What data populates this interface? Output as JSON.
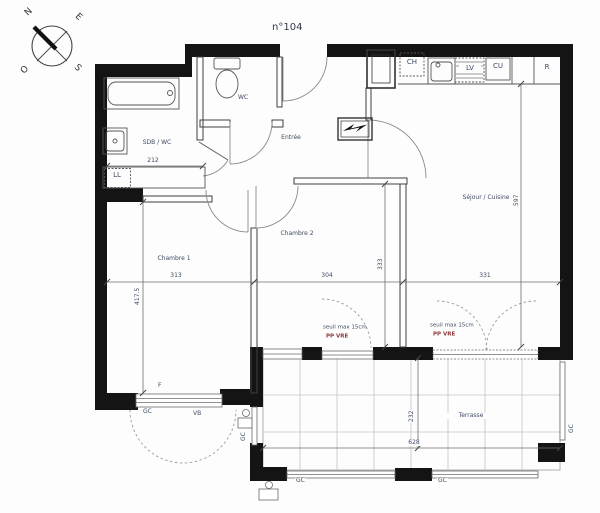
{
  "plan": {
    "title": "n°104",
    "compass": {
      "n": "N",
      "e": "E",
      "s": "S",
      "o": "O"
    },
    "rooms": {
      "sdb": "SDB / WC",
      "wc": "WC",
      "entree": "Entrée",
      "sejour": "Séjour / Cuisine",
      "chambre1": "Chambre 1",
      "chambre2": "Chambre 2",
      "terrasse": "Terrasse"
    },
    "fixtures": {
      "ll": "LL",
      "ch": "CH",
      "lv": "LV",
      "cu": "CU",
      "r": "R",
      "f": "F",
      "vb": "VB",
      "gc": "GC"
    },
    "notes": {
      "seuil": "seuil max 15cm",
      "pp_vre": "PP VRE"
    },
    "dims": {
      "sdb_width": "212",
      "chambre1_width": "313",
      "chambre1_depth": "417.5",
      "chambre2_width": "304",
      "chambre2_depth": "333",
      "sejour_width": "331",
      "sejour_depth": "597",
      "terrasse_width": "628",
      "terrasse_depth": "232"
    },
    "colors": {
      "wall": "#141414",
      "interior_line": "#3f3f3f",
      "arc_line": "#8a8a8a",
      "grid": "#c4c4c4",
      "text": "#3d4a63",
      "note_red": "#8a3535"
    }
  }
}
